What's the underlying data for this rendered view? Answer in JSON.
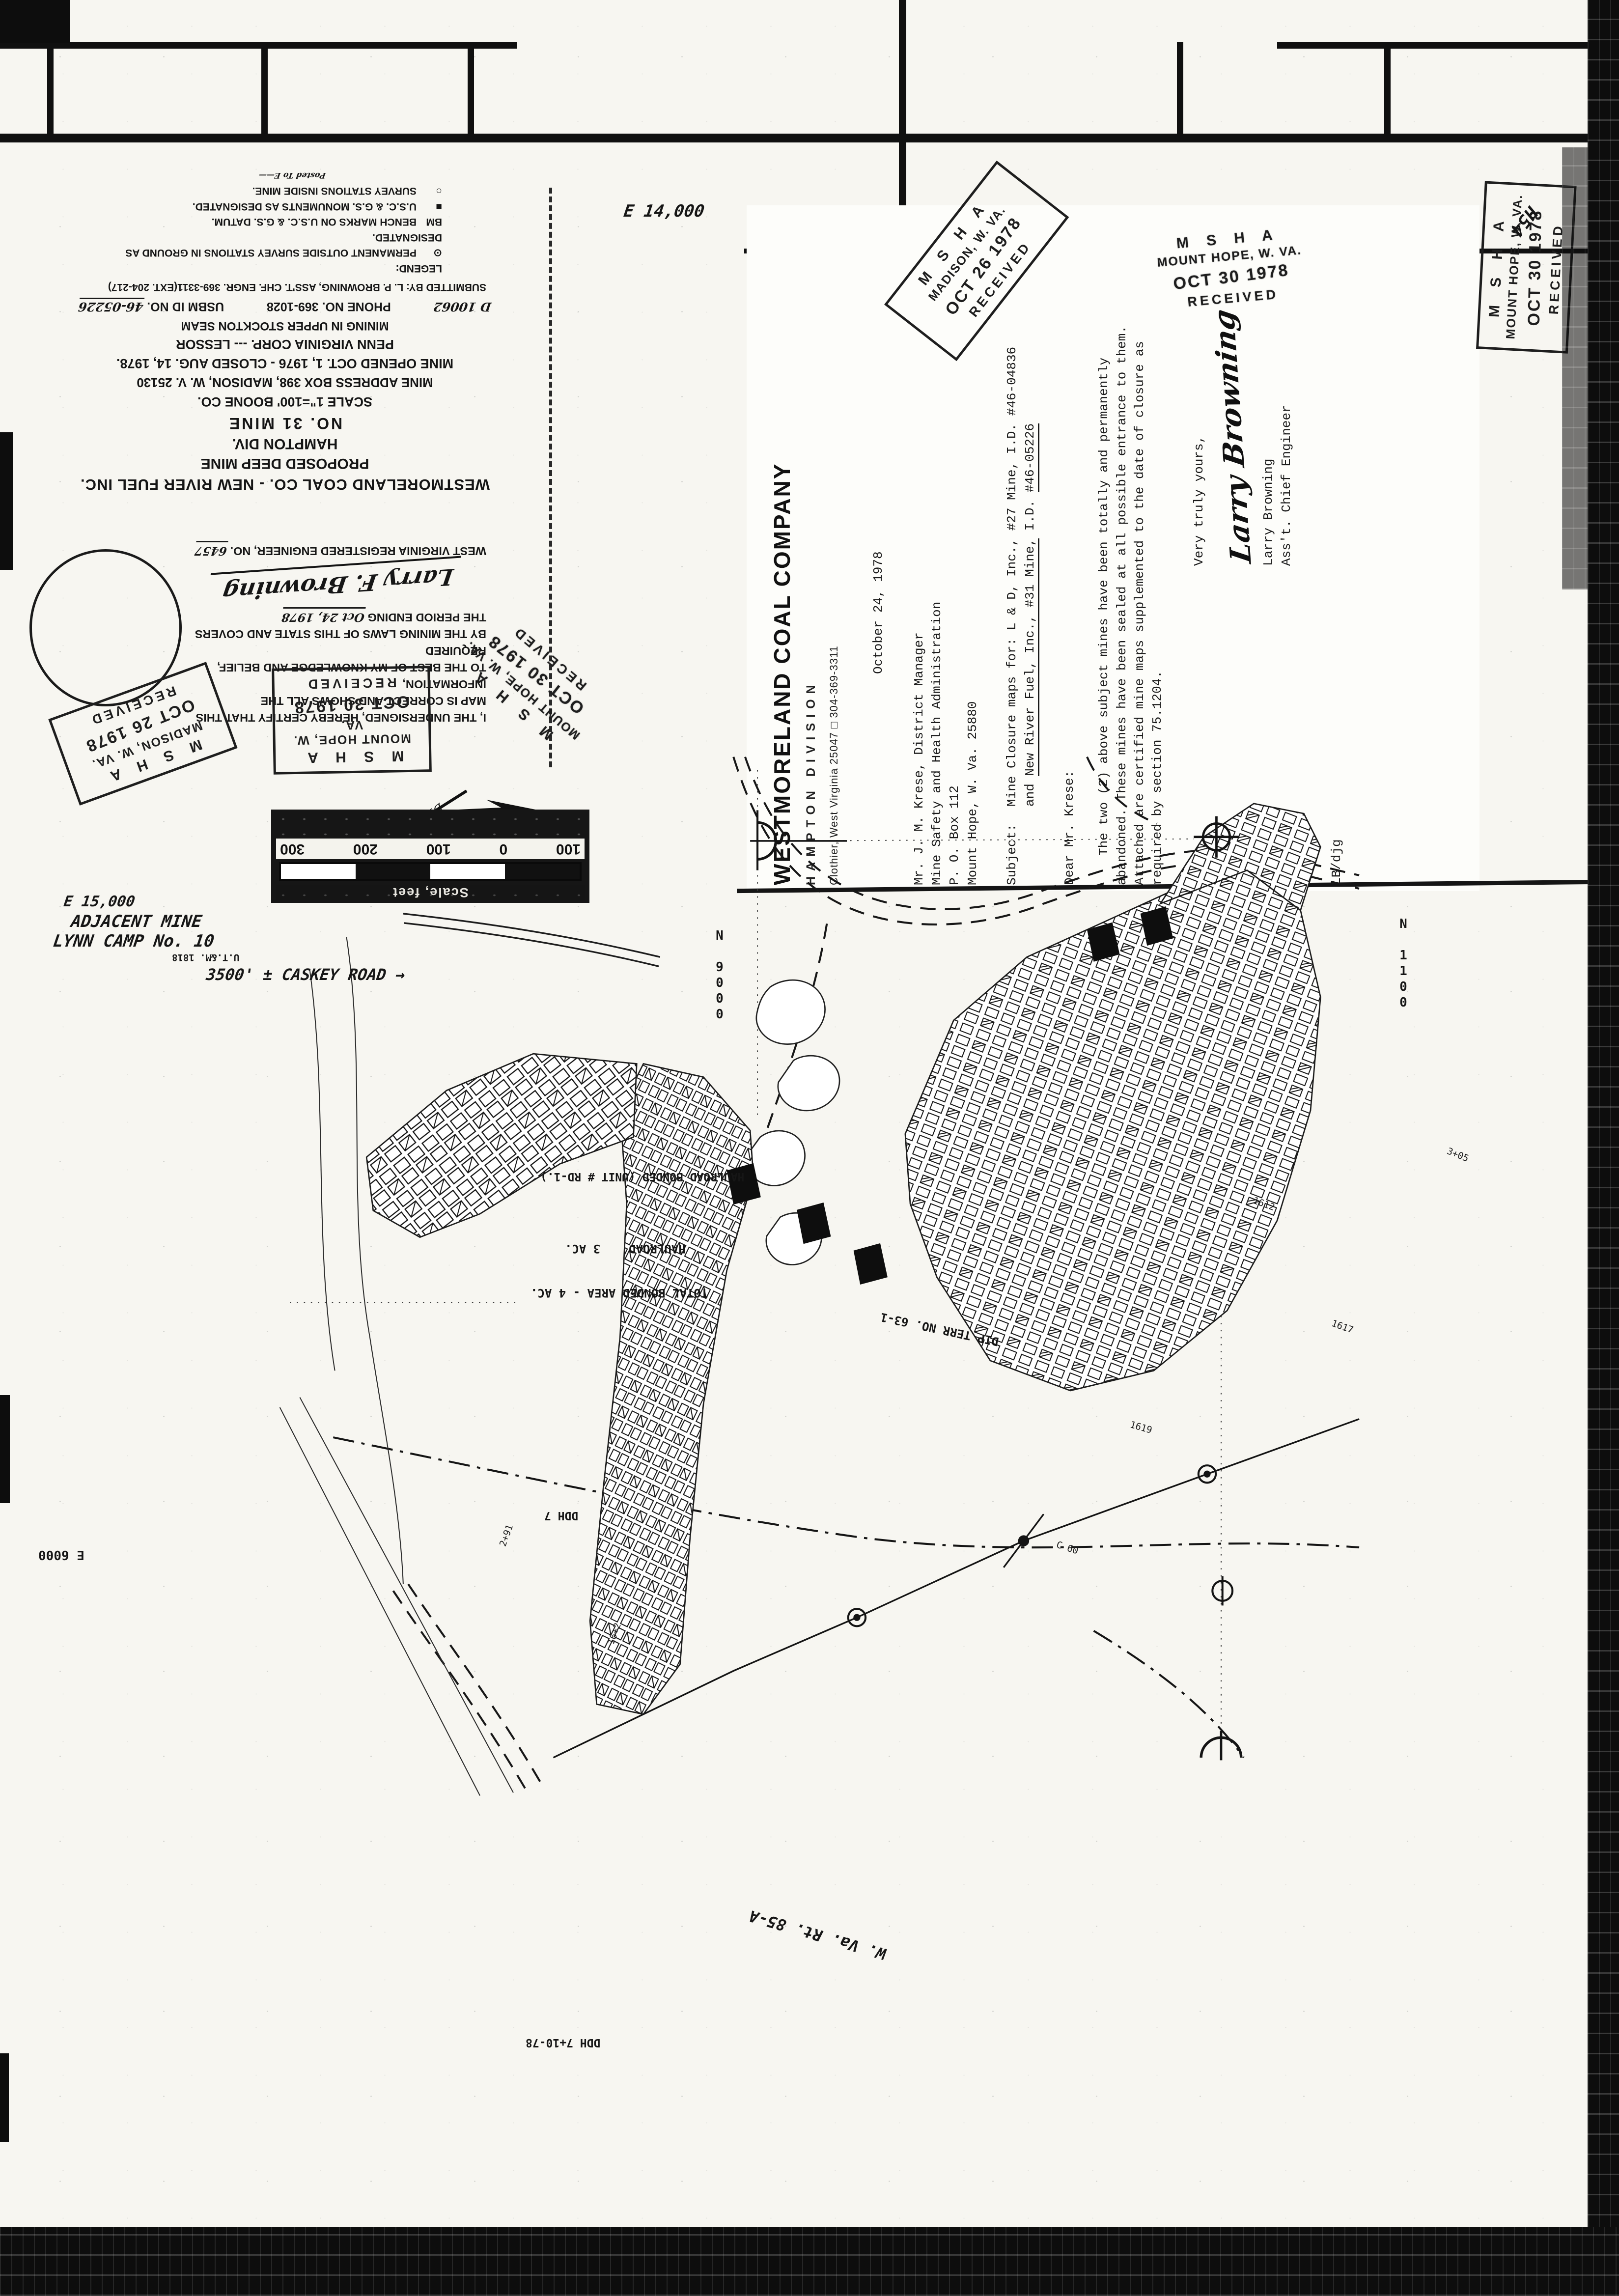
{
  "letter": {
    "company": "WESTMORELAND COAL COMPANY",
    "division": "HAMPTON DIVISION",
    "contact": "Clothier, West Virginia 25047 □ 304-369-3311",
    "date": "October 24, 1978",
    "to": [
      "Mr. J. M. Krese, District Manager",
      "Mine Safety and Health Administration",
      "P. O. Box 112",
      "Mount Hope, W. Va.  25880"
    ],
    "subject_label": "Subject:",
    "subject_line1": "Mine Closure maps for:  L & D, Inc., #27 Mine, I.D. #46-04836",
    "subject_line2_pre": "and ",
    "subject_line2_u1": "New River Fuel, Inc., #31 Mine,",
    "subject_line2_mid": " I.D. ",
    "subject_line2_u2": "#46-05226",
    "salutation": "Dear Mr. Krese:",
    "body": [
      "The two (2) above subject mines have been totally and permanently",
      "abandoned.  These mines have been sealed at all possible entrance to them.",
      "Attached are certified mine maps supplemented to the date of closure as",
      "required by section 75.1204."
    ],
    "closing": "Very truly yours,",
    "signature_script": "Larry Browning",
    "signer_name": "Larry Browning",
    "signer_title": "Ass't. Chief Engineer",
    "reference": "LB/djg"
  },
  "stamps": {
    "madison_top": {
      "agency": "M S H A",
      "office": "MADISON, W. VA.",
      "date": "OCT 26 1978",
      "status": "RECEIVED"
    },
    "mount_hope_ink": {
      "agency": "M S H A",
      "office": "MOUNT HOPE, W. VA.",
      "date": "OCT 30 1978",
      "status": "RECEIVED"
    },
    "mount_hope_boxed": {
      "agency": "M S H A",
      "office": "MOUNT HOPE, W. VA.",
      "date": "OCT 30 1978",
      "status": "RECEIVED"
    },
    "madison_cert": {
      "agency": "M S H A",
      "office": "MADISON, W. VA.",
      "date": "OCT 26 1978",
      "status": "RECEIVED"
    },
    "mount_hope_cert": {
      "agency": "M S H A",
      "office": "MOUNT HOPE, W. VA.",
      "date": "OCT 30 1978",
      "status": "RECEIVED"
    },
    "mount_hope_diag": {
      "agency": "M S H A",
      "office": "MOUNT HOPE, W. VA.",
      "date": "OCT 30 1978",
      "status": "RECEIVED"
    }
  },
  "title_block": {
    "company_line": "WESTMORELAND COAL CO. - NEW RIVER FUEL INC.",
    "type_line": "PROPOSED DEEP MINE",
    "division_line": "HAMPTON DIV.",
    "mine_line": "NO. 31  MINE",
    "scale_line": "SCALE 1\"=100'    BOONE CO.",
    "address_line": "MINE ADDRESS BOX 398, MADISON, W. V. 25130",
    "dates_line": "MINE OPENED OCT. 1, 1976 - CLOSED AUG. 14, 1978.",
    "lessor_line": "PENN VIRGINIA CORP. --- LESSOR",
    "seam_line": "MINING IN UPPER STOCKTON SEAM",
    "phone_line": "PHONE NO. 369-1028",
    "permit_hand": "D 10062",
    "usbm_label": "USBM ID NO.",
    "usbm_no": "46-05226",
    "submitted_line": "SUBMITTED BY: L. P. BROWNING, ASS'T. CHF. ENGR. 369-3311(EXT. 204-217)",
    "legend_title": "LEGEND:",
    "legend": [
      {
        "symbol": "⊙",
        "text": "PERMANENT OUTSIDE SURVEY STATIONS IN GROUND AS DESIGNATED."
      },
      {
        "symbol": "BM",
        "text": "BENCH MARKS ON U.S.C. & G.S. DATUM."
      },
      {
        "symbol": "■",
        "text": "U.S.C. & G.S. MONUMENTS AS DESIGNATED."
      },
      {
        "symbol": "○",
        "text": "SURVEY STATIONS INSIDE MINE."
      }
    ],
    "posted_hand": "Posted To E——",
    "north_label": "N",
    "dip_label": "DIP OF COAL N48°24'W"
  },
  "certification": {
    "lines": [
      "I, THE UNDERSIGNED, HEREBY CERTIFY THAT THIS",
      "MAP IS CORRECT AND SHOWS ALL THE INFORMATION,",
      "TO THE BEST OF MY KNOWLEDGE AND BELIEF, REQUIRED",
      "BY THE MINING LAWS OF THIS STATE AND COVERS",
      "THE PERIOD ENDING"
    ],
    "period_date": "Oct 24, 1978",
    "signature": "Larry F. Browning",
    "engineer_label": "WEST VIRGINIA REGISTERED ENGINEER, NO.",
    "engineer_no": "6457"
  },
  "scale_bar": {
    "title": "Scale, feet",
    "ticks": [
      "100",
      "0",
      "100",
      "200",
      "300"
    ]
  },
  "map": {
    "labels": {
      "n9000": "N 9000",
      "n11000": "N 1100",
      "e6000": "E 6000",
      "e15000": "E 15,000",
      "e14000": "E 14,000",
      "adjacent_line1": "ADJACENT MINE",
      "adjacent_line2": "LYNN CAMP No. 10",
      "caskey": "3500' ± CASKEY ROAD →",
      "utem": "U.T.&M. 1818",
      "dip_terr": "DIP TERR  NO. 63-1",
      "haulroad_bonded": "HAULROAD BONDED (UNIT # RD-1.)",
      "haulroad": "HAULROAD",
      "haulroad_area": "3 AC.",
      "total_bonded": "TOTAL BONDED AREA - 4 AC.",
      "ddh_a": "DDH 7",
      "ddh_b": "DDH 7+10-78",
      "route": "W. Va. Rt. 85-A",
      "h54": "H54"
    },
    "spots": [
      "1612",
      "1617",
      "1619",
      "16+2",
      "2+91",
      "3+05",
      "C 60"
    ]
  }
}
